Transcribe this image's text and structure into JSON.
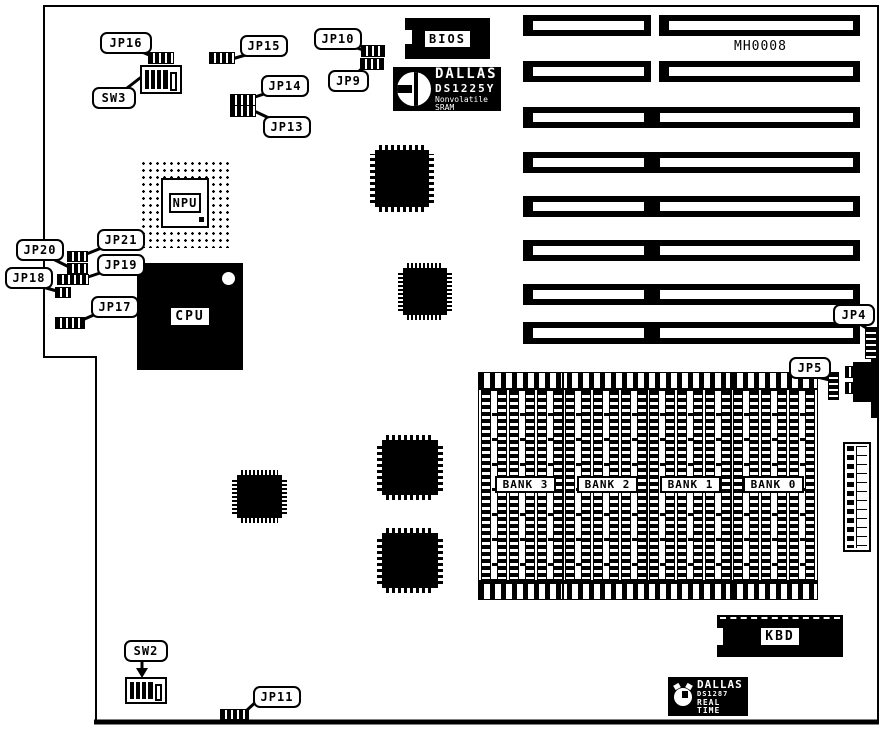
{
  "diagram": {
    "part_number": "MH0008"
  },
  "callouts": {
    "jp4": "JP4",
    "jp5": "JP5",
    "jp9": "JP9",
    "jp10": "JP10",
    "jp11": "JP11",
    "jp13": "JP13",
    "jp14": "JP14",
    "jp15": "JP15",
    "jp16": "JP16",
    "jp17": "JP17",
    "jp18": "JP18",
    "jp19": "JP19",
    "jp20": "JP20",
    "jp21": "JP21",
    "sw2": "SW2",
    "sw3": "SW3"
  },
  "chips": {
    "bios": "BIOS",
    "cpu": "CPU",
    "npu": "NPU",
    "kbd": "KBD"
  },
  "memory_banks": [
    "BANK 3",
    "BANK 2",
    "BANK 1",
    "BANK 0"
  ],
  "dallas_nvram": {
    "brand": "DALLAS",
    "model": "DS1225Y",
    "desc": "Nonvolatile SRAM"
  },
  "dallas_rtc": {
    "brand": "DALLAS",
    "model": "DS1287",
    "desc": "REAL TIME"
  },
  "colors": {
    "ink": "#000000",
    "paper": "#ffffff"
  }
}
